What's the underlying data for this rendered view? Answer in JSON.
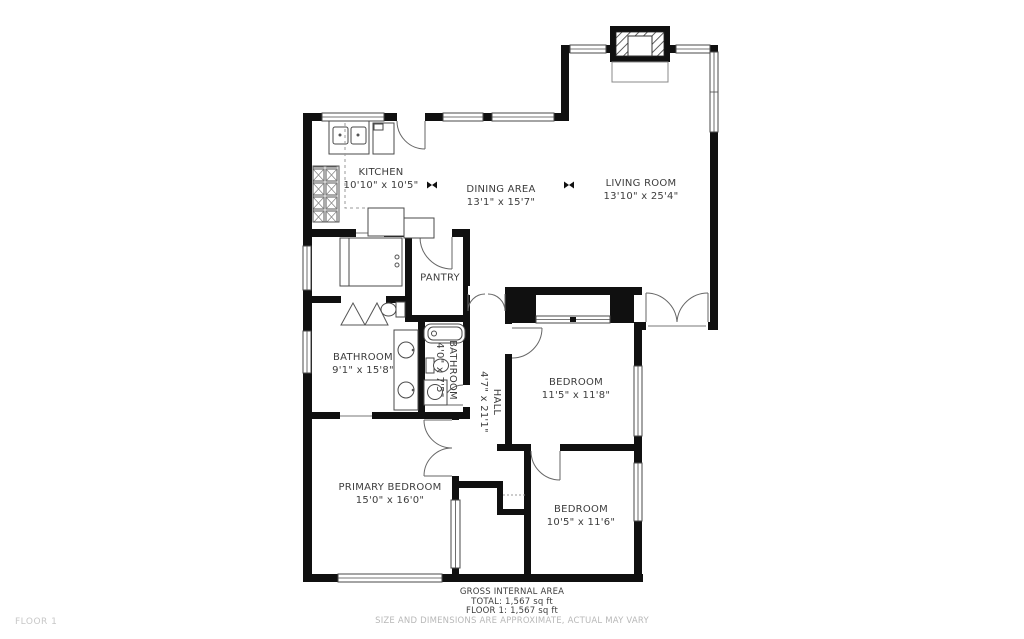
{
  "floor_label": "FLOOR 1",
  "rooms": [
    {
      "name": "KITCHEN",
      "dims": "10'10\" x 10'5\""
    },
    {
      "name": "DINING AREA",
      "dims": "13'1\" x 15'7\""
    },
    {
      "name": "LIVING ROOM",
      "dims": "13'10\" x 25'4\""
    },
    {
      "name": "PANTRY",
      "dims": ""
    },
    {
      "name": "BATHROOM",
      "dims": "9'1\" x 15'8\""
    },
    {
      "name": "BATHROOM",
      "dims": "4'0\" x 7'5\""
    },
    {
      "name": "HALL",
      "dims": "4'7\" x 21'1\""
    },
    {
      "name": "BEDROOM",
      "dims": "11'5\" x 11'8\""
    },
    {
      "name": "BEDROOM",
      "dims": "10'5\" x 11'6\""
    },
    {
      "name": "PRIMARY BEDROOM",
      "dims": "15'0\" x 16'0\""
    }
  ],
  "footer": {
    "title": "GROSS INTERNAL AREA",
    "total": "TOTAL: 1,567 sq ft",
    "floor": "FLOOR 1: 1,567 sq ft",
    "disclaimer": "SIZE AND DIMENSIONS ARE APPROXIMATE, ACTUAL MAY VARY"
  },
  "colors": {
    "wall": "#101010",
    "label": "#3d3d3d",
    "muted": "#b8b8b8",
    "floor_tag": "#c7c7c7"
  }
}
